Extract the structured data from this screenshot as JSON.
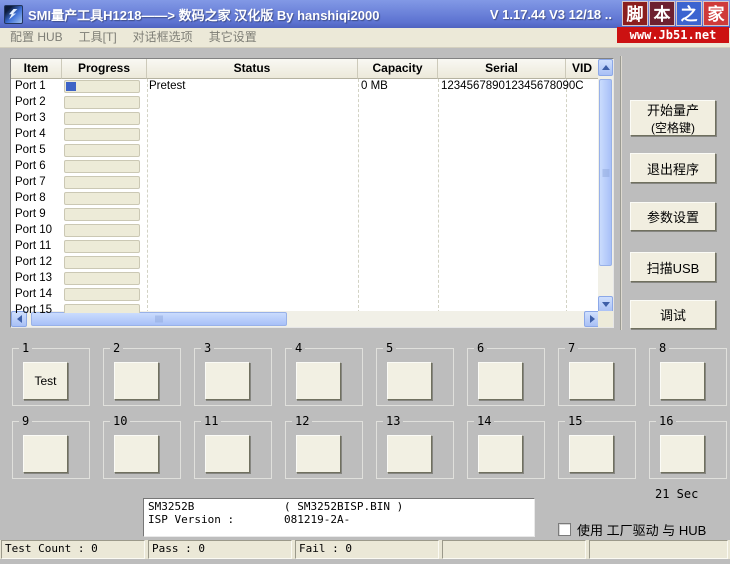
{
  "titlebar": {
    "title": "SMI量产工具H1218——> 数码之家 汉化版 By hanshiqi2000",
    "version": "V 1.17.44 V3 12/18 ..",
    "watermark": {
      "chars": [
        "脚",
        "本",
        "之",
        "家"
      ],
      "url": "www.Jb51.net"
    }
  },
  "menu": {
    "items": [
      "配置 HUB",
      "工具[T]",
      "对话框选项",
      "其它设置"
    ]
  },
  "table": {
    "columns": [
      "Item",
      "Progress",
      "Status",
      "Capacity",
      "Serial",
      "VID"
    ],
    "rows": [
      {
        "item": "Port 1",
        "progress": 13,
        "status": "Pretest",
        "capacity": "0 MB",
        "serial": "123456789012345678090C"
      },
      {
        "item": "Port 2",
        "progress": 0,
        "status": "",
        "capacity": "",
        "serial": ""
      },
      {
        "item": "Port 3",
        "progress": 0,
        "status": "",
        "capacity": "",
        "serial": ""
      },
      {
        "item": "Port 4",
        "progress": 0,
        "status": "",
        "capacity": "",
        "serial": ""
      },
      {
        "item": "Port 5",
        "progress": 0,
        "status": "",
        "capacity": "",
        "serial": ""
      },
      {
        "item": "Port 6",
        "progress": 0,
        "status": "",
        "capacity": "",
        "serial": ""
      },
      {
        "item": "Port 7",
        "progress": 0,
        "status": "",
        "capacity": "",
        "serial": ""
      },
      {
        "item": "Port 8",
        "progress": 0,
        "status": "",
        "capacity": "",
        "serial": ""
      },
      {
        "item": "Port 9",
        "progress": 0,
        "status": "",
        "capacity": "",
        "serial": ""
      },
      {
        "item": "Port 10",
        "progress": 0,
        "status": "",
        "capacity": "",
        "serial": ""
      },
      {
        "item": "Port 11",
        "progress": 0,
        "status": "",
        "capacity": "",
        "serial": ""
      },
      {
        "item": "Port 12",
        "progress": 0,
        "status": "",
        "capacity": "",
        "serial": ""
      },
      {
        "item": "Port 13",
        "progress": 0,
        "status": "",
        "capacity": "",
        "serial": ""
      },
      {
        "item": "Port 14",
        "progress": 0,
        "status": "",
        "capacity": "",
        "serial": ""
      },
      {
        "item": "Port 15",
        "progress": 0,
        "status": "",
        "capacity": "",
        "serial": ""
      }
    ]
  },
  "actions": {
    "buttons": [
      {
        "label": "开始量产",
        "sub": "(空格键)"
      },
      {
        "label": "退出程序",
        "sub": ""
      },
      {
        "label": "参数设置",
        "sub": ""
      },
      {
        "label": "扫描USB",
        "sub": ""
      },
      {
        "label": "调试",
        "sub": ""
      }
    ]
  },
  "test_grid": {
    "groups": [
      {
        "num": "1",
        "label": "Test"
      },
      {
        "num": "2",
        "label": ""
      },
      {
        "num": "3",
        "label": ""
      },
      {
        "num": "4",
        "label": ""
      },
      {
        "num": "5",
        "label": ""
      },
      {
        "num": "6",
        "label": ""
      },
      {
        "num": "7",
        "label": ""
      },
      {
        "num": "8",
        "label": ""
      },
      {
        "num": "9",
        "label": ""
      },
      {
        "num": "10",
        "label": ""
      },
      {
        "num": "11",
        "label": ""
      },
      {
        "num": "12",
        "label": ""
      },
      {
        "num": "13",
        "label": ""
      },
      {
        "num": "14",
        "label": ""
      },
      {
        "num": "15",
        "label": ""
      },
      {
        "num": "16",
        "label": ""
      }
    ]
  },
  "timer": "21 Sec",
  "info_box": {
    "line1_left": "SM3252B",
    "line1_right": "( SM3252BISP.BIN )",
    "line2_left": "ISP Version :",
    "line2_right": "081219-2A-"
  },
  "checkbox": {
    "label": "使用 工厂驱动 与 HUB",
    "checked": false
  },
  "statusbar": {
    "panels": [
      "Test Count : 0",
      "Pass : 0",
      "Fail : 0",
      "",
      ""
    ]
  },
  "colors": {
    "titlebar": "#6b82db",
    "progress_chunk": "#3e63c6",
    "watermark_red": "#cc1111",
    "watermark_blue": "#3c64d0",
    "scrollbar_thumb": "#b9cefa",
    "button_face": "#f1eee0"
  }
}
